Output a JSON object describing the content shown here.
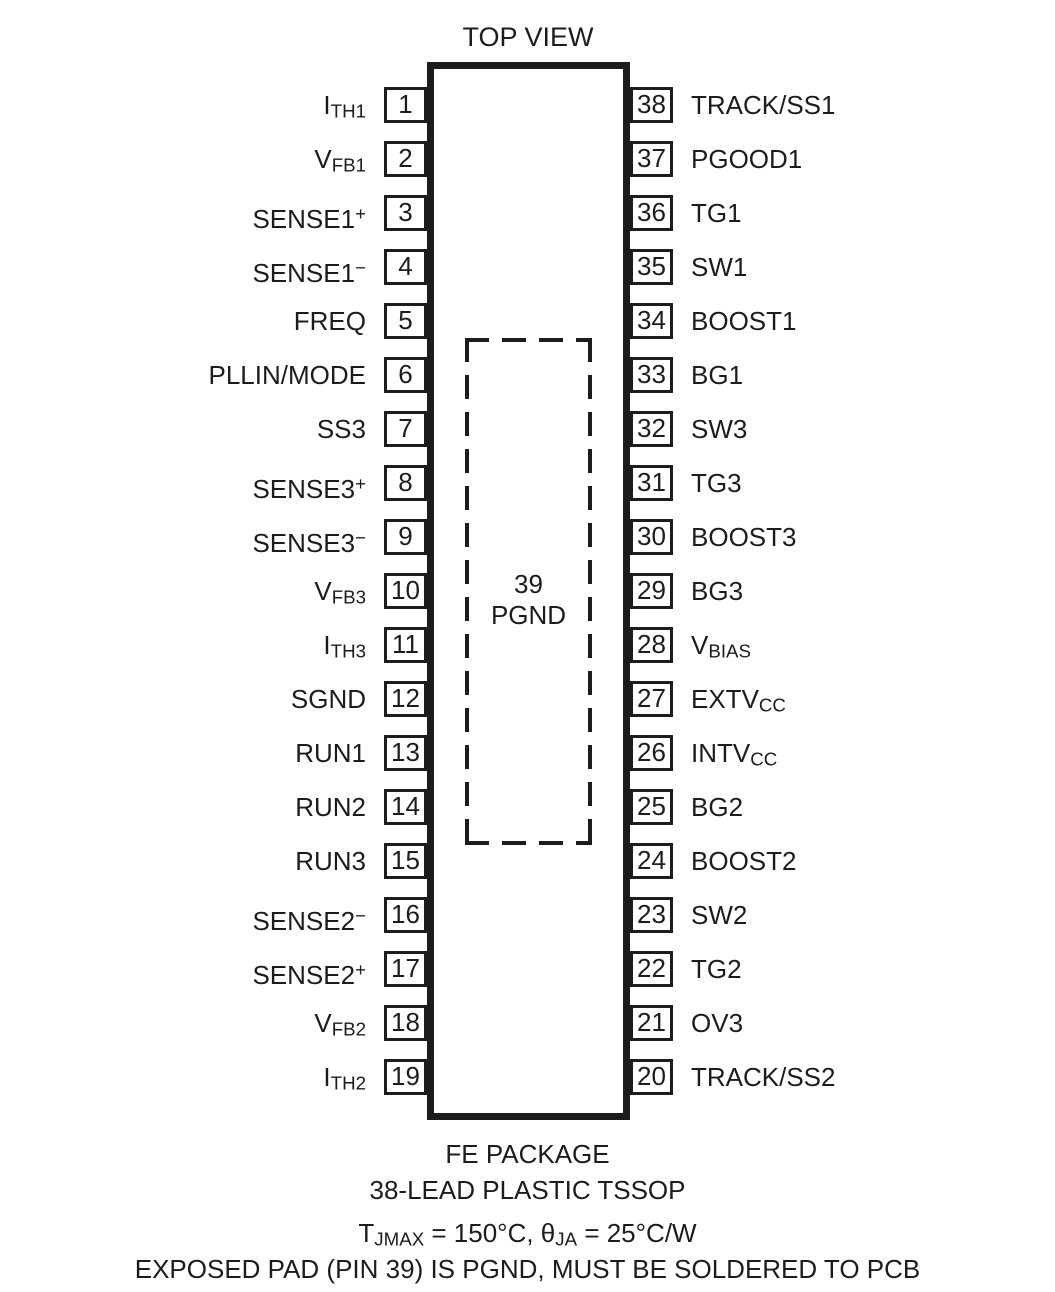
{
  "title": "TOP VIEW",
  "colors": {
    "line": "#1c1c1c",
    "background": "#ffffff"
  },
  "exposed_pad": {
    "pin_number": "39",
    "label": "PGND"
  },
  "footer": {
    "package_line1": "FE PACKAGE",
    "package_line2": "38-LEAD PLASTIC TSSOP",
    "thermal_segments": [
      {
        "t": "T"
      },
      {
        "t": "JMAX",
        "sub": true
      },
      {
        "t": " = 150°C, θ"
      },
      {
        "t": "JA",
        "sub": true
      },
      {
        "t": " = 25°C/W"
      }
    ],
    "note": "EXPOSED PAD (PIN 39) IS PGND, MUST BE SOLDERED TO PCB"
  },
  "rows": [
    {
      "left": {
        "num": "1",
        "label": [
          {
            "t": "I"
          },
          {
            "t": "TH1",
            "sub": true
          }
        ]
      },
      "right": {
        "num": "38",
        "label": [
          {
            "t": "TRACK/SS1"
          }
        ]
      }
    },
    {
      "left": {
        "num": "2",
        "label": [
          {
            "t": "V"
          },
          {
            "t": "FB1",
            "sub": true
          }
        ]
      },
      "right": {
        "num": "37",
        "label": [
          {
            "t": "PGOOD1"
          }
        ]
      }
    },
    {
      "left": {
        "num": "3",
        "label": [
          {
            "t": "SENSE1"
          },
          {
            "t": "+",
            "sup": true
          }
        ]
      },
      "right": {
        "num": "36",
        "label": [
          {
            "t": "TG1"
          }
        ]
      }
    },
    {
      "left": {
        "num": "4",
        "label": [
          {
            "t": "SENSE1"
          },
          {
            "t": "−",
            "sup": true
          }
        ]
      },
      "right": {
        "num": "35",
        "label": [
          {
            "t": "SW1"
          }
        ]
      }
    },
    {
      "left": {
        "num": "5",
        "label": [
          {
            "t": "FREQ"
          }
        ]
      },
      "right": {
        "num": "34",
        "label": [
          {
            "t": "BOOST1"
          }
        ]
      }
    },
    {
      "left": {
        "num": "6",
        "label": [
          {
            "t": "PLLIN/MODE"
          }
        ]
      },
      "right": {
        "num": "33",
        "label": [
          {
            "t": "BG1"
          }
        ]
      }
    },
    {
      "left": {
        "num": "7",
        "label": [
          {
            "t": "SS3"
          }
        ]
      },
      "right": {
        "num": "32",
        "label": [
          {
            "t": "SW3"
          }
        ]
      }
    },
    {
      "left": {
        "num": "8",
        "label": [
          {
            "t": "SENSE3"
          },
          {
            "t": "+",
            "sup": true
          }
        ]
      },
      "right": {
        "num": "31",
        "label": [
          {
            "t": "TG3"
          }
        ]
      }
    },
    {
      "left": {
        "num": "9",
        "label": [
          {
            "t": "SENSE3"
          },
          {
            "t": "−",
            "sup": true
          }
        ]
      },
      "right": {
        "num": "30",
        "label": [
          {
            "t": "BOOST3"
          }
        ]
      }
    },
    {
      "left": {
        "num": "10",
        "label": [
          {
            "t": "V"
          },
          {
            "t": "FB3",
            "sub": true
          }
        ]
      },
      "right": {
        "num": "29",
        "label": [
          {
            "t": "BG3"
          }
        ]
      }
    },
    {
      "left": {
        "num": "11",
        "label": [
          {
            "t": "I"
          },
          {
            "t": "TH3",
            "sub": true
          }
        ]
      },
      "right": {
        "num": "28",
        "label": [
          {
            "t": "V"
          },
          {
            "t": "BIAS",
            "sub": true
          }
        ]
      }
    },
    {
      "left": {
        "num": "12",
        "label": [
          {
            "t": "SGND"
          }
        ]
      },
      "right": {
        "num": "27",
        "label": [
          {
            "t": "EXTV"
          },
          {
            "t": "CC",
            "sub": true
          }
        ]
      }
    },
    {
      "left": {
        "num": "13",
        "label": [
          {
            "t": "RUN1"
          }
        ]
      },
      "right": {
        "num": "26",
        "label": [
          {
            "t": "INTV"
          },
          {
            "t": "CC",
            "sub": true
          }
        ]
      }
    },
    {
      "left": {
        "num": "14",
        "label": [
          {
            "t": "RUN2"
          }
        ]
      },
      "right": {
        "num": "25",
        "label": [
          {
            "t": "BG2"
          }
        ]
      }
    },
    {
      "left": {
        "num": "15",
        "label": [
          {
            "t": "RUN3"
          }
        ]
      },
      "right": {
        "num": "24",
        "label": [
          {
            "t": "BOOST2"
          }
        ]
      }
    },
    {
      "left": {
        "num": "16",
        "label": [
          {
            "t": "SENSE2"
          },
          {
            "t": "−",
            "sup": true
          }
        ]
      },
      "right": {
        "num": "23",
        "label": [
          {
            "t": "SW2"
          }
        ]
      }
    },
    {
      "left": {
        "num": "17",
        "label": [
          {
            "t": "SENSE2"
          },
          {
            "t": "+",
            "sup": true
          }
        ]
      },
      "right": {
        "num": "22",
        "label": [
          {
            "t": "TG2"
          }
        ]
      }
    },
    {
      "left": {
        "num": "18",
        "label": [
          {
            "t": "V"
          },
          {
            "t": "FB2",
            "sub": true
          }
        ]
      },
      "right": {
        "num": "21",
        "label": [
          {
            "t": "OV3"
          }
        ]
      }
    },
    {
      "left": {
        "num": "19",
        "label": [
          {
            "t": "I"
          },
          {
            "t": "TH2",
            "sub": true
          }
        ]
      },
      "right": {
        "num": "20",
        "label": [
          {
            "t": "TRACK/SS2"
          }
        ]
      }
    }
  ]
}
